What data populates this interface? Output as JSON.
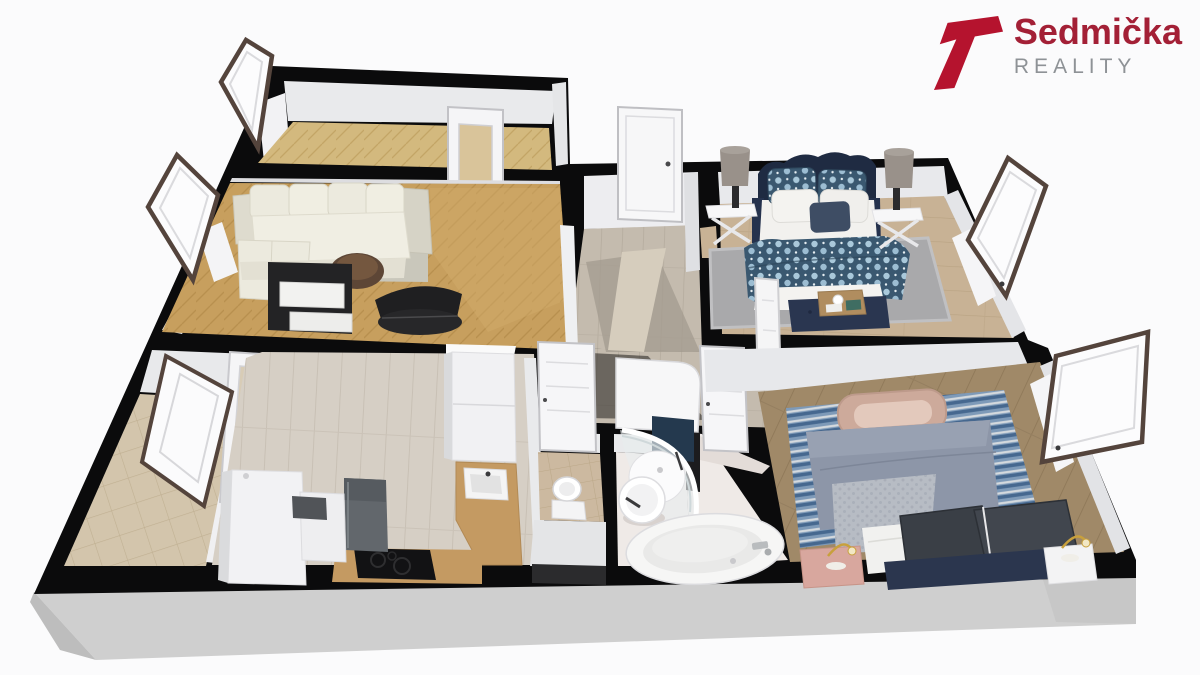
{
  "logo": {
    "brand": "Sedmička",
    "tagline": "REALITY",
    "mark_color": "#b5132e",
    "brand_color": "#a32036",
    "tagline_color": "#8e9296"
  },
  "scene": {
    "description": "3D rendered perspective floor plan of an apartment",
    "background_color": "#fbfbfc",
    "palette": {
      "wall": "#0b0b0c",
      "wall_face": "#e9eaec",
      "slab": "#cfcfcf",
      "parquet_living": "#c79f5e",
      "parquet_hall": "#d3b97e",
      "corridor_floor": "#c4bbae",
      "kitchen_floor": "#d6cfc5",
      "loggia_tile": "#d3c5ac",
      "wc_tile": "#ccb9a0",
      "bathroom_floor": "#efeae7",
      "bedroom1_floor": "#c8b295",
      "bedroom2_floor": "#a08968",
      "rug_gray": "#a9a9ab",
      "rug_blue": "#7e9ab8",
      "bed_navy": "#22304a",
      "floral_textile": "#3a5870",
      "window_frame": "#54443c",
      "counter_wood": "#c49a62",
      "sofa_cream": "#eceade"
    }
  }
}
